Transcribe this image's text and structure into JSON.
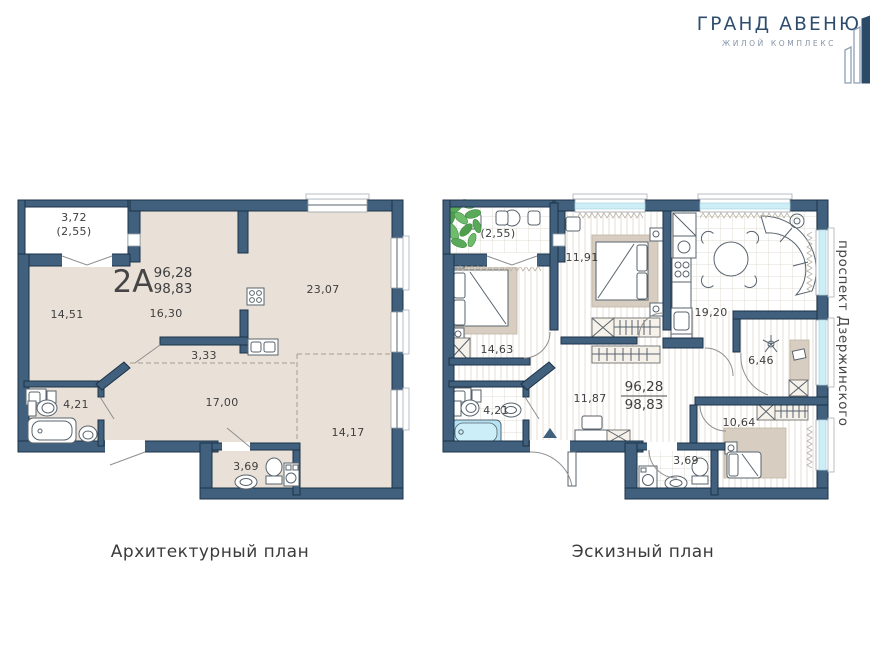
{
  "logo": {
    "title": "ГРАНД АВЕНЮ",
    "subtitle": "ЖИЛОЙ КОМПЛЕКС"
  },
  "street_label": "проспект Дзержинского",
  "colors": {
    "wall_navy": "#41607d",
    "window_cyan": "#cdeef6",
    "floor_beige": "#e9e1d7",
    "tub_blue": "#b5e3f4"
  },
  "plans": {
    "architectural": {
      "caption": "Архитектурный план",
      "apartment": {
        "code": "2A",
        "area_living": "96,28",
        "area_total": "98,83"
      },
      "labels": {
        "balcony": "3,72",
        "balcony_coeff": "(2,55)",
        "room1": "14,51",
        "room2": "16,30",
        "kitchen_living": "23,07",
        "kitchen_niche": "3,33",
        "bathroom": "4,21",
        "hallway": "17,00",
        "bedroom": "14,17",
        "wc": "3,69"
      }
    },
    "sketch": {
      "caption": "Эскизный план",
      "apartment": {
        "area_living": "96,28",
        "area_total": "98,83"
      },
      "labels": {
        "balcony_coeff": "(2,55)",
        "bedroom1": "11,91",
        "bedroom2": "14,63",
        "bathroom": "4,21",
        "hallway": "11,87",
        "kitchen_living": "19,20",
        "wardrobe": "6,46",
        "bedroom3": "10,64",
        "wc": "3,69"
      }
    }
  }
}
